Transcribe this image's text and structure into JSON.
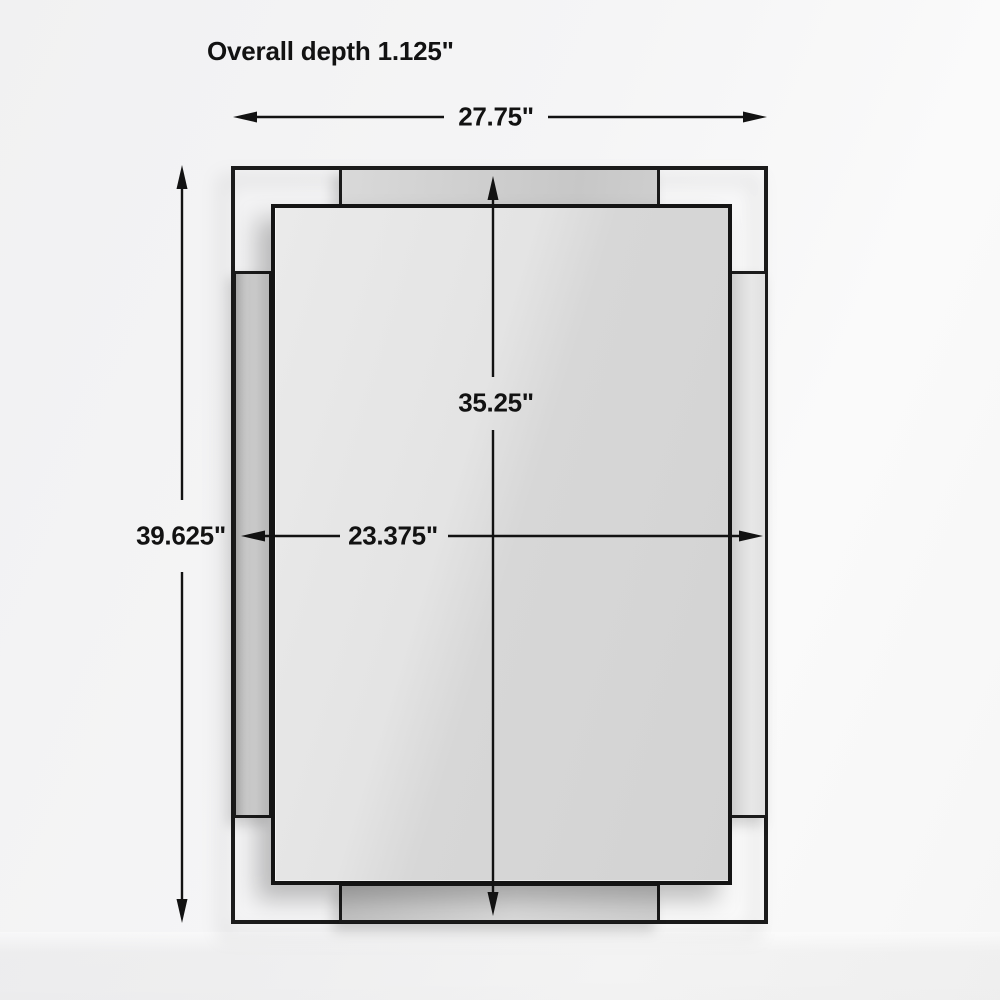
{
  "diagram": {
    "title": "Overall depth 1.125\"",
    "dimensions": {
      "overall_width": "27.75\"",
      "overall_height": "39.625\"",
      "inner_height": "35.25\"",
      "inner_width": "23.375\""
    },
    "colors": {
      "frame": "#1b1b1b",
      "text": "#121212",
      "background": "#f5f5f6"
    }
  }
}
